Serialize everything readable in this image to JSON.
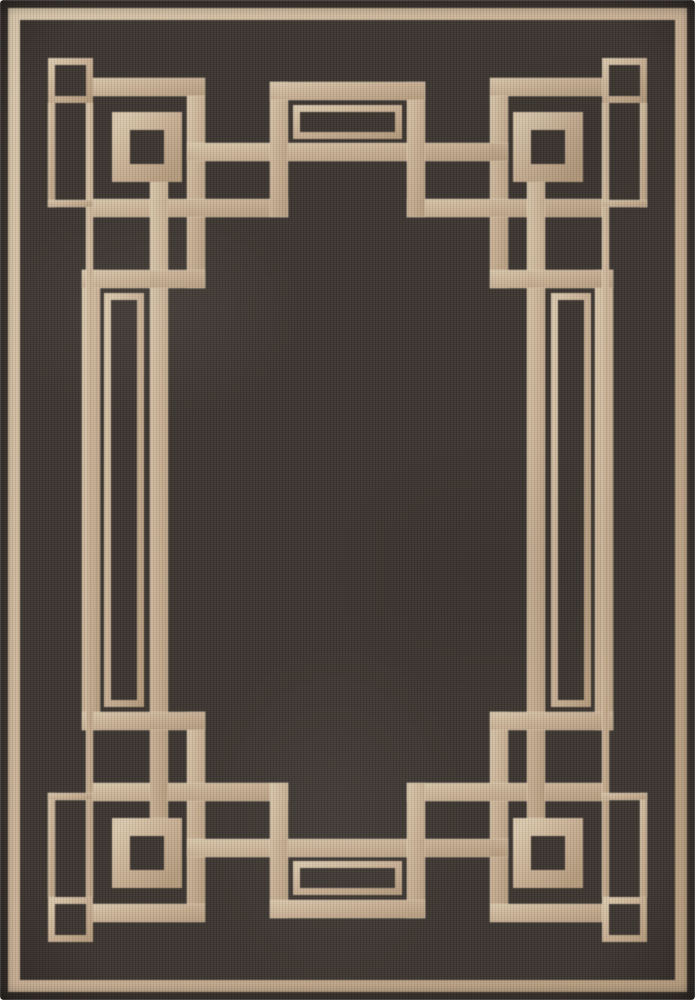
{
  "scene": {
    "kind": "product-photo",
    "subject": "flat-weave area rug, dark charcoal field with tan greek-key fret border"
  },
  "rug": {
    "canvas": {
      "width": 695,
      "height": 1000
    },
    "palette": {
      "field": "#3c3530",
      "field_edge": "#2c2622",
      "tan": "#c9b094",
      "tan_light": "#dbc9ad",
      "tan_dark": "#b79d7e",
      "rim_highlight": "#e9dcc4",
      "page": "#f6f4f0"
    },
    "stroke_widths": {
      "binding": 12,
      "thin": 7,
      "thick": 18,
      "medallion_ring": 18
    },
    "binding_outline": {
      "name": "edge-binding",
      "x": 8,
      "y": 8,
      "w": 679,
      "h": 984
    },
    "pattern": {
      "thick_fills": [
        {
          "name": "top-band-left",
          "x": 93,
          "y": 78,
          "w": 112,
          "h": 18
        },
        {
          "name": "top-band-right",
          "x": 490,
          "y": 78,
          "w": 112,
          "h": 18
        },
        {
          "name": "top-left-descender",
          "x": 187,
          "y": 96,
          "w": 18,
          "h": 192
        },
        {
          "name": "top-right-descender",
          "x": 490,
          "y": 96,
          "w": 18,
          "h": 192
        },
        {
          "name": "top-long-rail",
          "x": 187,
          "y": 143,
          "w": 321,
          "h": 18
        },
        {
          "name": "top-hook-left",
          "x": 93,
          "y": 199,
          "w": 195,
          "h": 18
        },
        {
          "name": "top-hook-right",
          "x": 407,
          "y": 199,
          "w": 195,
          "h": 18
        },
        {
          "name": "top-bump-riser-left",
          "x": 270,
          "y": 82,
          "w": 18,
          "h": 135
        },
        {
          "name": "top-bump-riser-right",
          "x": 407,
          "y": 82,
          "w": 18,
          "h": 135
        },
        {
          "name": "top-bump-cap",
          "x": 270,
          "y": 82,
          "w": 155,
          "h": 18
        },
        {
          "name": "bottom-band-left",
          "x": 93,
          "y": 904,
          "w": 112,
          "h": 18
        },
        {
          "name": "bottom-band-right",
          "x": 490,
          "y": 904,
          "w": 112,
          "h": 18
        },
        {
          "name": "bottom-left-ascender",
          "x": 187,
          "y": 712,
          "w": 18,
          "h": 192
        },
        {
          "name": "bottom-right-ascender",
          "x": 490,
          "y": 712,
          "w": 18,
          "h": 192
        },
        {
          "name": "bottom-long-rail",
          "x": 187,
          "y": 839,
          "w": 321,
          "h": 18
        },
        {
          "name": "bottom-hook-left",
          "x": 93,
          "y": 783,
          "w": 195,
          "h": 18
        },
        {
          "name": "bottom-hook-right",
          "x": 407,
          "y": 783,
          "w": 195,
          "h": 18
        },
        {
          "name": "bottom-bump-riser-left",
          "x": 270,
          "y": 783,
          "w": 18,
          "h": 135
        },
        {
          "name": "bottom-bump-riser-right",
          "x": 407,
          "y": 783,
          "w": 18,
          "h": 135
        },
        {
          "name": "bottom-bump-cap",
          "x": 270,
          "y": 900,
          "w": 155,
          "h": 18
        },
        {
          "name": "left-long-rail",
          "x": 150,
          "y": 182,
          "w": 18,
          "h": 636
        },
        {
          "name": "left-bump-side",
          "x": 82,
          "y": 270,
          "w": 18,
          "h": 460
        },
        {
          "name": "left-bump-top",
          "x": 82,
          "y": 270,
          "w": 123,
          "h": 18
        },
        {
          "name": "left-bump-bottom",
          "x": 82,
          "y": 712,
          "w": 123,
          "h": 18
        },
        {
          "name": "right-long-rail",
          "x": 527,
          "y": 182,
          "w": 18,
          "h": 636
        },
        {
          "name": "right-bump-side",
          "x": 595,
          "y": 270,
          "w": 18,
          "h": 460
        },
        {
          "name": "right-bump-top",
          "x": 490,
          "y": 270,
          "w": 123,
          "h": 18
        },
        {
          "name": "right-bump-bottom",
          "x": 490,
          "y": 712,
          "w": 123,
          "h": 18
        }
      ],
      "thin_fills": [
        {
          "name": "left-frame-line",
          "x": 86,
          "y": 103,
          "w": 7,
          "h": 794
        },
        {
          "name": "right-frame-line",
          "x": 602,
          "y": 103,
          "w": 7,
          "h": 794
        },
        {
          "name": "slot-tl-vertical",
          "x": 48,
          "y": 103,
          "w": 7,
          "h": 104
        },
        {
          "name": "slot-tl-horizontal",
          "x": 48,
          "y": 200,
          "w": 45,
          "h": 7
        },
        {
          "name": "slot-tr-vertical",
          "x": 640,
          "y": 103,
          "w": 7,
          "h": 104
        },
        {
          "name": "slot-tr-horizontal",
          "x": 602,
          "y": 200,
          "w": 45,
          "h": 7
        },
        {
          "name": "slot-bl-vertical",
          "x": 48,
          "y": 793,
          "w": 7,
          "h": 104
        },
        {
          "name": "slot-bl-horizontal",
          "x": 48,
          "y": 793,
          "w": 45,
          "h": 7
        },
        {
          "name": "slot-br-vertical",
          "x": 640,
          "y": 793,
          "w": 7,
          "h": 104
        },
        {
          "name": "slot-br-horizontal",
          "x": 602,
          "y": 793,
          "w": 45,
          "h": 7
        }
      ],
      "thin_outlines": [
        {
          "name": "corner-loop-square-tl",
          "x": 48,
          "y": 58,
          "w": 45,
          "h": 45
        },
        {
          "name": "corner-loop-square-tr",
          "x": 602,
          "y": 58,
          "w": 45,
          "h": 45
        },
        {
          "name": "corner-loop-square-bl",
          "x": 48,
          "y": 897,
          "w": 45,
          "h": 45
        },
        {
          "name": "corner-loop-square-br",
          "x": 602,
          "y": 897,
          "w": 45,
          "h": 45
        },
        {
          "name": "top-bump-inner-rect",
          "x": 293,
          "y": 105,
          "w": 109,
          "h": 34
        },
        {
          "name": "bottom-bump-inner-rect",
          "x": 293,
          "y": 861,
          "w": 109,
          "h": 34
        },
        {
          "name": "left-bump-inner-rect",
          "x": 104,
          "y": 293,
          "w": 40,
          "h": 414
        },
        {
          "name": "right-bump-inner-rect",
          "x": 551,
          "y": 293,
          "w": 40,
          "h": 414
        }
      ],
      "medallion_outlines": [
        {
          "name": "corner-medallion-tl",
          "x": 112,
          "y": 112,
          "w": 70,
          "h": 70
        },
        {
          "name": "corner-medallion-tr",
          "x": 513,
          "y": 112,
          "w": 70,
          "h": 70
        },
        {
          "name": "corner-medallion-bl",
          "x": 112,
          "y": 818,
          "w": 70,
          "h": 70
        },
        {
          "name": "corner-medallion-br",
          "x": 513,
          "y": 818,
          "w": 70,
          "h": 70
        }
      ]
    }
  }
}
